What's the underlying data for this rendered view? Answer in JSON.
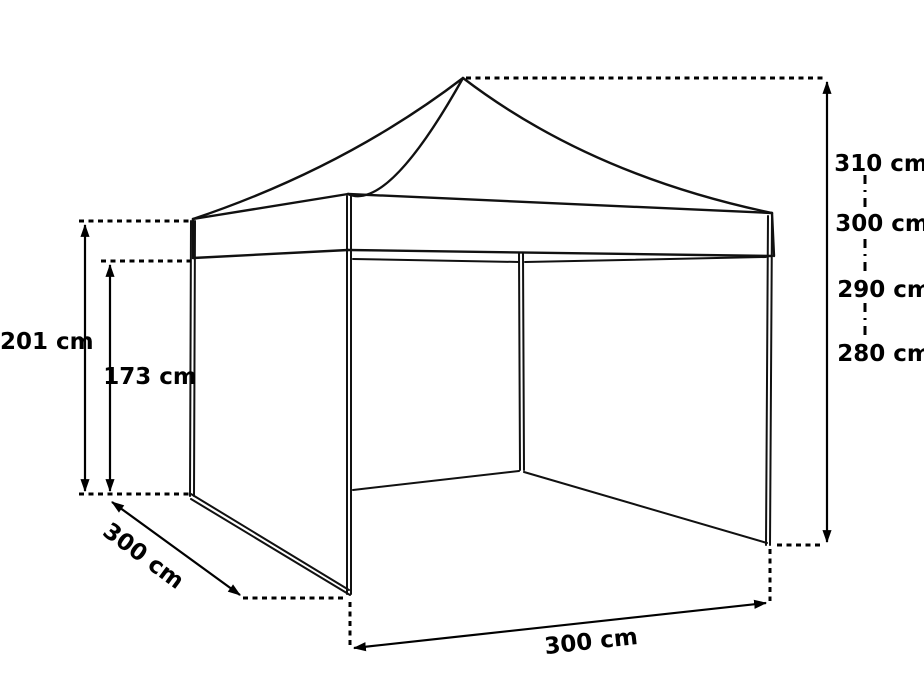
{
  "title": "Pop-up gazebo tent dimensions diagram",
  "colors": {
    "background": "#ffffff",
    "line": "#111111",
    "text": "#000000"
  },
  "dimensions": {
    "back_wall_height": "201 cm",
    "inner_wall_height": "173 cm",
    "side_depth": "300 cm",
    "front_width": "300 cm",
    "overall_heights": [
      "310 cm",
      "300 cm",
      "290 cm",
      "280 cm"
    ]
  }
}
